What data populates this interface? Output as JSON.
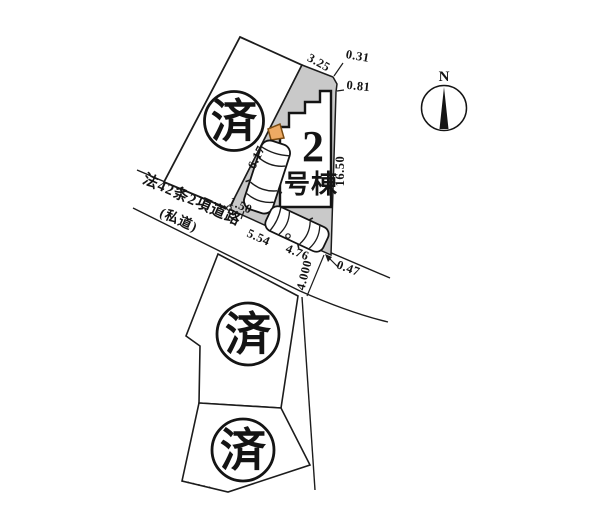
{
  "building": {
    "number": "2",
    "suffix": "号棟"
  },
  "stamps": {
    "sold": "済"
  },
  "north": {
    "label": "N"
  },
  "road": {
    "name": "法42条2項道路",
    "type": "(私道)"
  },
  "dimensions": {
    "north_edge": "3.25",
    "northeast_offset_a": "0.31",
    "northeast_offset_b": "0.81",
    "west_boundary": "6.17",
    "east_boundary": "16.50",
    "frontage_a": "1.50",
    "frontage_b": "5.54",
    "frontage_c": "4.76",
    "road_width": "4.000",
    "southeast_offset": "0.47"
  },
  "colors": {
    "lot_gray": "#c9c9c9",
    "entrance_orange": "#edaa64",
    "ink": "#1c1c1c"
  }
}
